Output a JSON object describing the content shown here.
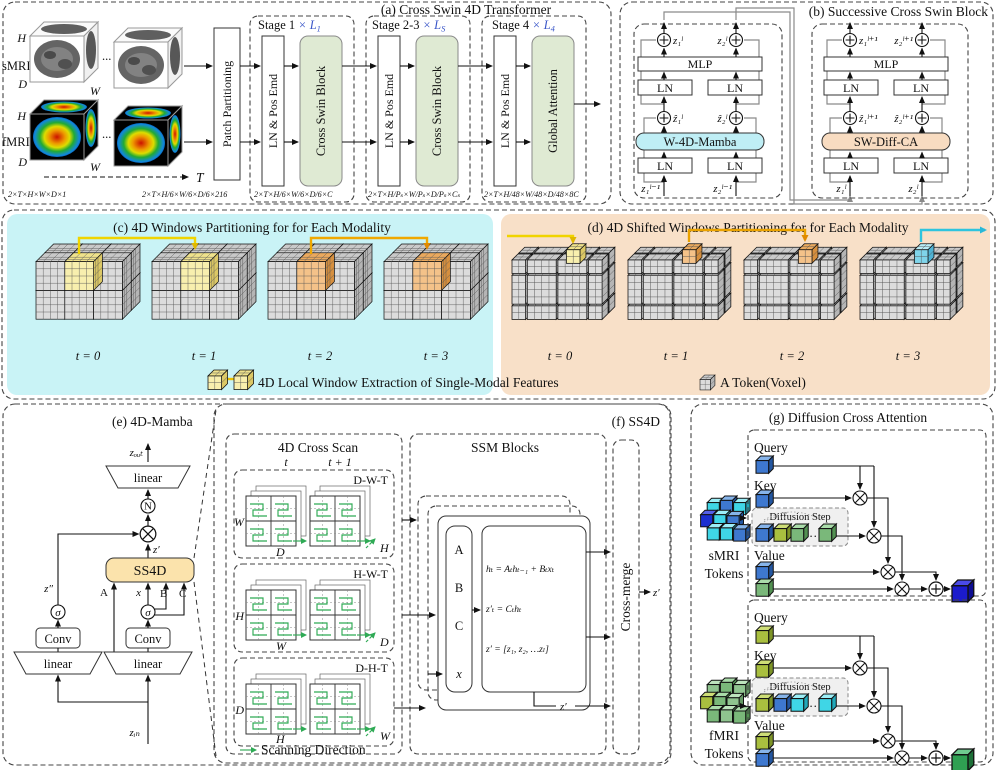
{
  "colors": {
    "panel_gray": "#ededed",
    "panel_green": "#e6edda",
    "panel_cyan": "#c9f3f6",
    "panel_peach": "#f8e0c8",
    "panel_yellow": "#fdf0cd",
    "block_green": "#dfead3",
    "mamba_cyan": "#bfeef5",
    "diffca_peach": "#f8dcc1",
    "ss4d_yellow": "#fbe3ac",
    "stage_blue": "#3a56c8",
    "scan_green": "#2faa55",
    "highlight_yellow": "#f8efae",
    "highlight_orange": "#f4c289"
  },
  "panel_a": {
    "title": "(a) Cross Swin 4D Transformer",
    "smri": "sMRI",
    "fmri": "fMRI",
    "h": "H",
    "d": "D",
    "w": "W",
    "t": "T",
    "dots": "...",
    "patch": "Patch Partitioning",
    "ln_pos": "LN & Pos Emd",
    "csb": "Cross Swin Block",
    "ga": "Global Attention",
    "stages": [
      {
        "name": "Stage 1",
        "mult": "× L",
        "sub": "1"
      },
      {
        "name": "Stage 2-3",
        "mult": "× L",
        "sub": "S"
      },
      {
        "name": "Stage 4",
        "mult": "× L",
        "sub": "4"
      }
    ],
    "dims": [
      "2×T×H×W×D×1",
      "2×T×H/6×W/6×D/6×216",
      "2×T×H/6×W/6×D/6×C",
      "2×T×H/Pₛ×W/Pₛ×D/Pₛ×Cₛ",
      "2×T×H/48×W/48×D/48×8C"
    ]
  },
  "panel_b": {
    "title": "(b) Successive Cross Swin Block",
    "mlp": "MLP",
    "ln": "LN",
    "left": {
      "core": "W-4D-Mamba",
      "o1": "z₁ˡ",
      "o2": "z₂ˡ",
      "m1": "ẑ₁ˡ",
      "m2": "ẑ₂ˡ",
      "i1": "z₁ˡ⁻¹",
      "i2": "z₂ˡ⁻¹"
    },
    "right": {
      "core": "SW-Diff-CA",
      "o1": "z₁ˡ⁺¹",
      "o2": "z₂ˡ⁺¹",
      "m1": "ẑ₁ˡ⁺¹",
      "m2": "ẑ₂ˡ⁺¹",
      "i1": "z₁ˡ",
      "i2": "z₂ˡ"
    }
  },
  "panel_c": {
    "title": "(c) 4D Windows Partitioning for for Each Modality",
    "t": [
      "t = 0",
      "t = 1",
      "t = 2",
      "t = 3"
    ]
  },
  "panel_d": {
    "title": "(d) 4D Shifted Windows Partitioning for for Each Modality",
    "t": [
      "t = 0",
      "t = 1",
      "t = 2",
      "t = 3"
    ]
  },
  "legend": {
    "window": "4D Local Window Extraction of Single-Modal Features",
    "token": "A Token(Voxel)"
  },
  "panel_e": {
    "title": "(e) 4D-Mamba",
    "zout": "zₒᵤₜ",
    "zin": "zᵢₙ",
    "zp": "z′",
    "zpp": "z″",
    "linear": "linear",
    "conv": "Conv",
    "ss4d": "SS4D",
    "sigma": "σ",
    "n": "N",
    "A": "A",
    "B": "B",
    "C": "C",
    "x": "x"
  },
  "panel_f": {
    "title": "(f) SS4D",
    "scan_title": "4D Cross Scan",
    "t": "t",
    "t1": "t + 1",
    "scans": [
      {
        "name": "D-W-T",
        "left": "W",
        "bottom": "D",
        "right": "H"
      },
      {
        "name": "H-W-T",
        "left": "H",
        "bottom": "W",
        "right": "D"
      },
      {
        "name": "D-H-T",
        "left": "D",
        "bottom": "H",
        "right": "W"
      }
    ],
    "scan_dir": "Scanning Direction",
    "ssm": "SSM Blocks",
    "A": "A",
    "B": "B",
    "C": "C",
    "x": "x",
    "eq1": "hₜ = Aₜhₜ₋₁ + Bₜxₜ",
    "eq2": "z′ₜ = Cₜhₜ",
    "eq3": "z′ = [z₁, z₂, …zₗ]",
    "merge": "Cross-merge",
    "zp": "z′"
  },
  "panel_g": {
    "title": "(g) Diffusion Cross Attention",
    "smri1": "sMRI",
    "smri2": "Tokens",
    "fmri1": "fMRI",
    "fmri2": "Tokens",
    "query": "Query",
    "key": "Key",
    "diff": "Diffusion Step",
    "value": "Value",
    "dots": "…"
  }
}
